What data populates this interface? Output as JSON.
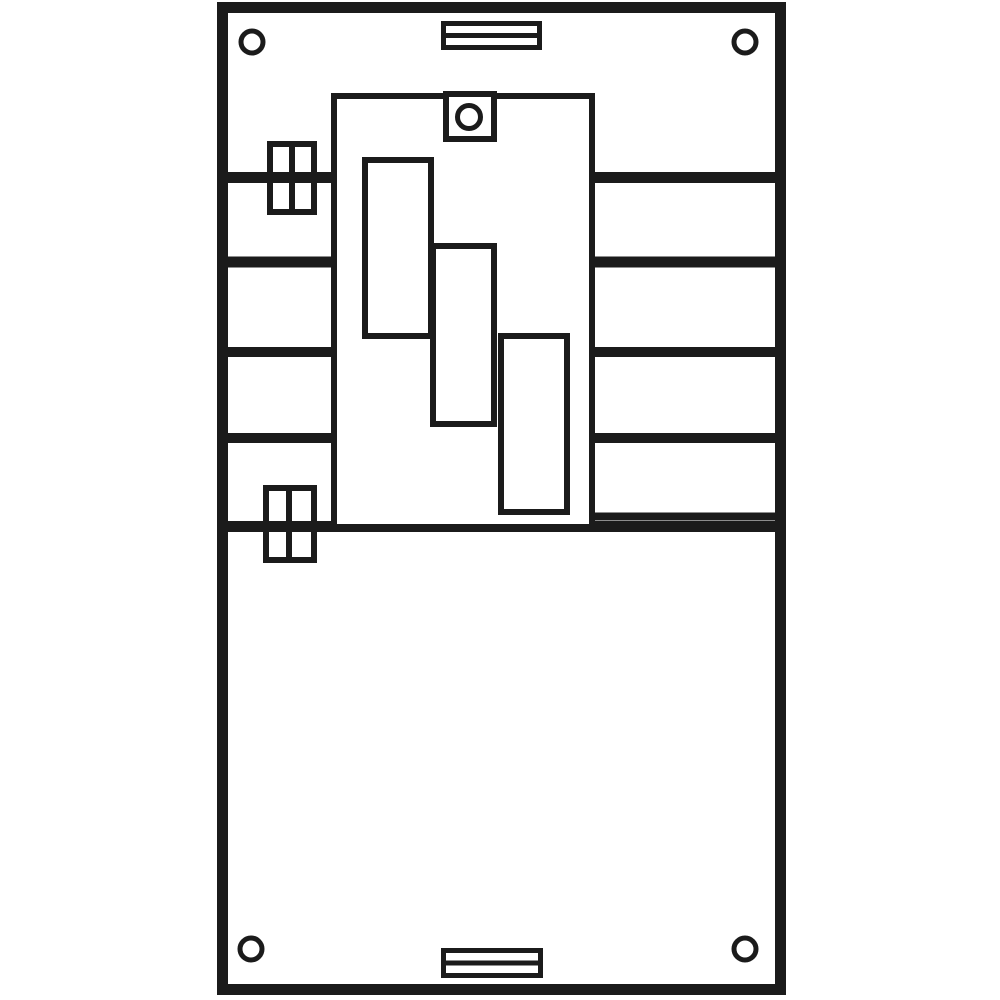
{
  "colors": {
    "ink": "#1b1b1b",
    "paper": "#ffffff"
  },
  "drawing": {
    "canvas": {
      "width": 1000,
      "height": 1000
    },
    "shapes": [
      {
        "name": "outer-frame",
        "kind": "rect",
        "x": 222.5,
        "y": 7.5,
        "w": 558,
        "h": 982,
        "sw": 11,
        "fill": "paper"
      },
      {
        "name": "rail-line-left-1",
        "kind": "line",
        "x1": 222,
        "y1": 177.5,
        "x2": 334,
        "y2": 177.5,
        "sw": 11
      },
      {
        "name": "rail-line-left-2",
        "kind": "line",
        "x1": 222,
        "y1": 262,
        "x2": 334,
        "y2": 262,
        "sw": 11
      },
      {
        "name": "rail-line-left-3",
        "kind": "line",
        "x1": 222,
        "y1": 352,
        "x2": 334,
        "y2": 352,
        "sw": 10
      },
      {
        "name": "rail-line-left-4",
        "kind": "line",
        "x1": 222,
        "y1": 438,
        "x2": 334,
        "y2": 438,
        "sw": 10
      },
      {
        "name": "rail-line-right-1",
        "kind": "line",
        "x1": 592,
        "y1": 177.5,
        "x2": 781,
        "y2": 177.5,
        "sw": 11
      },
      {
        "name": "rail-line-right-2",
        "kind": "line",
        "x1": 592,
        "y1": 262,
        "x2": 781,
        "y2": 262,
        "sw": 11
      },
      {
        "name": "rail-line-right-3",
        "kind": "line",
        "x1": 592,
        "y1": 352,
        "x2": 781,
        "y2": 352,
        "sw": 10
      },
      {
        "name": "rail-line-right-4",
        "kind": "line",
        "x1": 592,
        "y1": 438,
        "x2": 781,
        "y2": 438,
        "sw": 10
      },
      {
        "name": "rail-line-right-5",
        "kind": "line",
        "x1": 592,
        "y1": 516.5,
        "x2": 778,
        "y2": 516.5,
        "sw": 8
      },
      {
        "name": "full-width-divider",
        "kind": "line",
        "x1": 222.5,
        "y1": 526.5,
        "x2": 780.5,
        "y2": 526.5,
        "sw": 11
      },
      {
        "name": "mounting-plate",
        "kind": "rect",
        "x": 334,
        "y": 96,
        "w": 258,
        "h": 431,
        "sw": 6,
        "fill": "paper"
      },
      {
        "name": "meter-field-1",
        "kind": "rect",
        "x": 365,
        "y": 160,
        "w": 66,
        "h": 176,
        "sw": 6,
        "fill": "paper"
      },
      {
        "name": "meter-field-2",
        "kind": "rect",
        "x": 433,
        "y": 246,
        "w": 61,
        "h": 178,
        "sw": 6,
        "fill": "paper"
      },
      {
        "name": "meter-field-3",
        "kind": "rect",
        "x": 501,
        "y": 336,
        "w": 66,
        "h": 176,
        "sw": 6,
        "fill": "paper"
      },
      {
        "name": "sensor-square",
        "kind": "rect",
        "x": 446,
        "y": 94,
        "w": 48,
        "h": 45,
        "sw": 6,
        "fill": "paper"
      },
      {
        "name": "sensor-circle",
        "kind": "circle",
        "cx": 469,
        "cy": 117,
        "r": 11.5,
        "sw": 5,
        "fill": "paper"
      },
      {
        "name": "clamp-block-top",
        "kind": "rect",
        "x": 270,
        "y": 144,
        "w": 44,
        "h": 68,
        "sw": 6,
        "fill": "none"
      },
      {
        "name": "clamp-block-top-divider",
        "kind": "line",
        "x1": 292,
        "y1": 141,
        "x2": 292,
        "y2": 215,
        "sw": 6
      },
      {
        "name": "clamp-block-bottom",
        "kind": "rect",
        "x": 266,
        "y": 488,
        "w": 48,
        "h": 72,
        "sw": 6,
        "fill": "none"
      },
      {
        "name": "clamp-block-bottom-divider",
        "kind": "line",
        "x1": 289,
        "y1": 485,
        "x2": 289,
        "y2": 563,
        "sw": 6
      },
      {
        "name": "vent-slot-top",
        "kind": "rect",
        "x": 443.5,
        "y": 23.5,
        "w": 96,
        "h": 24,
        "sw": 5,
        "fill": "paper"
      },
      {
        "name": "vent-slot-top-divider",
        "kind": "line",
        "x1": 441,
        "y1": 35.5,
        "x2": 542,
        "y2": 35.5,
        "sw": 5
      },
      {
        "name": "vent-slot-bottom",
        "kind": "rect",
        "x": 443.5,
        "y": 950.5,
        "w": 97,
        "h": 25,
        "sw": 5,
        "fill": "paper"
      },
      {
        "name": "vent-slot-bottom-divider",
        "kind": "line",
        "x1": 441,
        "y1": 963,
        "x2": 543,
        "y2": 963,
        "sw": 5
      },
      {
        "name": "screw-hole-top-left",
        "kind": "circle",
        "cx": 252,
        "cy": 42,
        "r": 11,
        "sw": 5,
        "fill": "paper"
      },
      {
        "name": "screw-hole-top-right",
        "kind": "circle",
        "cx": 745,
        "cy": 42,
        "r": 11,
        "sw": 5,
        "fill": "paper"
      },
      {
        "name": "screw-hole-bottom-left",
        "kind": "circle",
        "cx": 251,
        "cy": 949,
        "r": 11,
        "sw": 5,
        "fill": "paper"
      },
      {
        "name": "screw-hole-bottom-right",
        "kind": "circle",
        "cx": 745,
        "cy": 949,
        "r": 11,
        "sw": 5,
        "fill": "paper"
      }
    ]
  }
}
